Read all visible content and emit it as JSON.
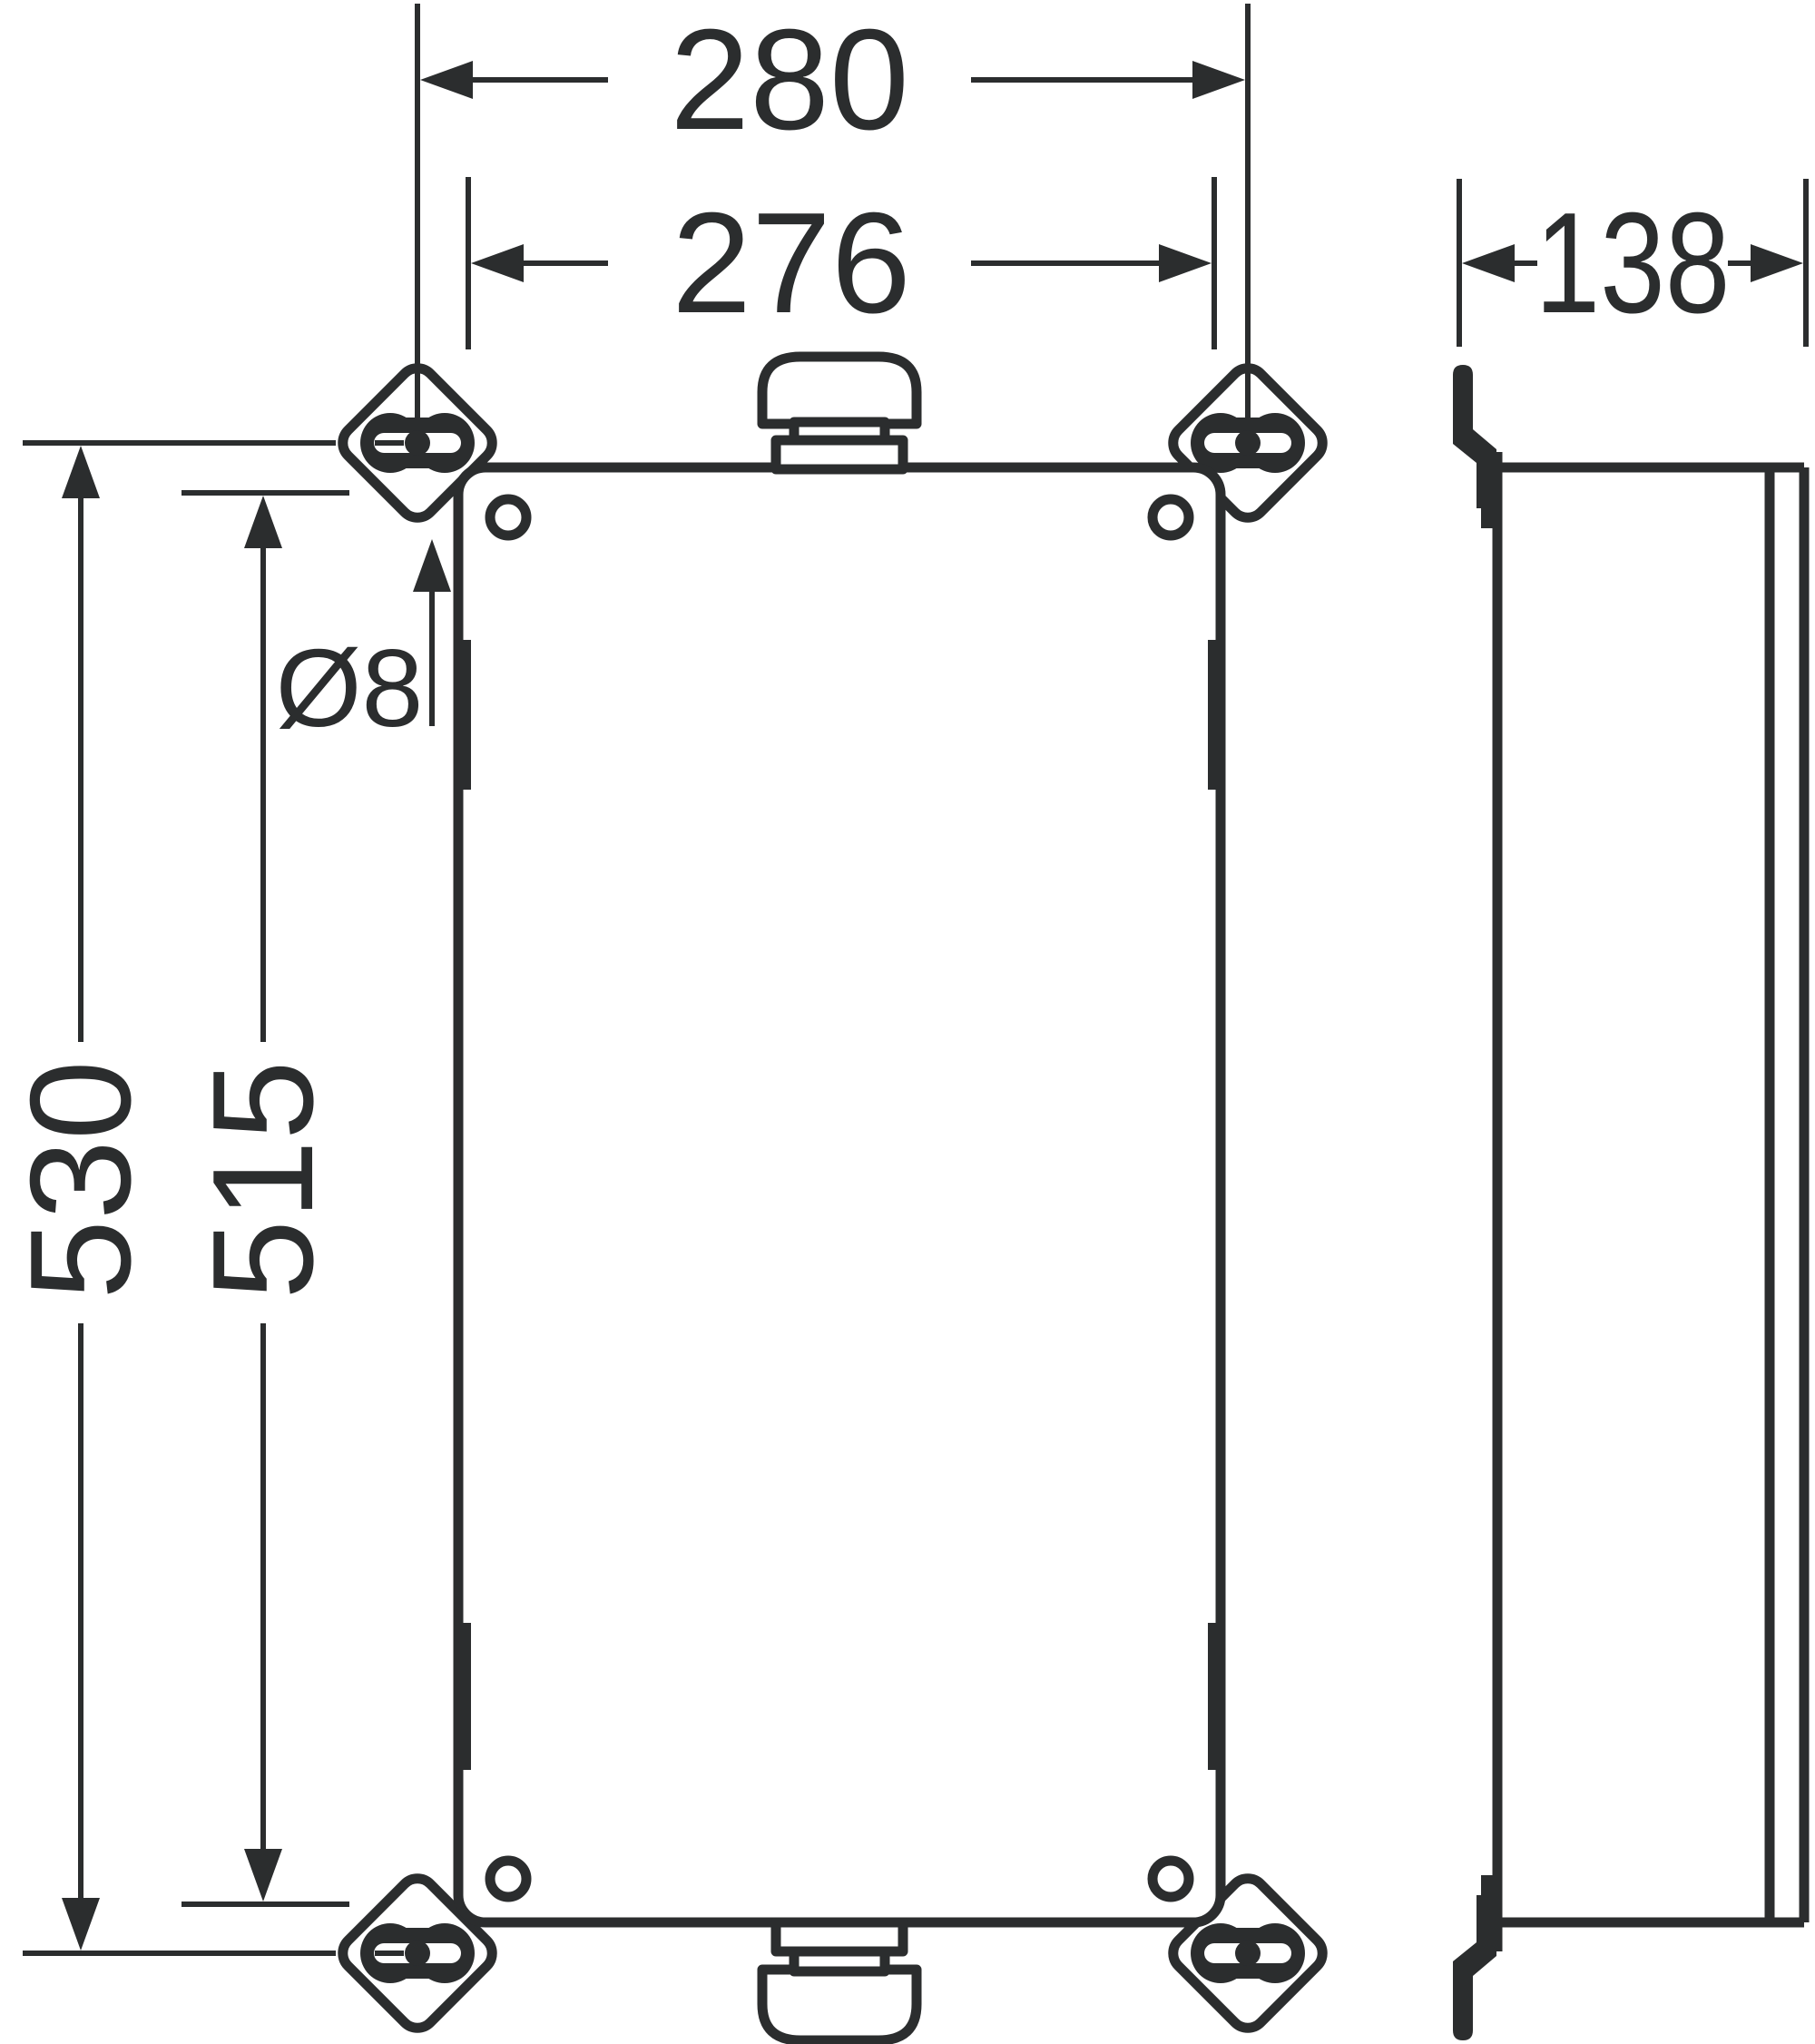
{
  "drawing": {
    "background_color": "#ffffff",
    "line_color": "#2b2d2e",
    "labels": {
      "overall_width": "280",
      "fixing_width": "276",
      "overall_height": "530",
      "fixing_height": "515",
      "hole_diameter": "Ø8",
      "depth": "138"
    }
  }
}
